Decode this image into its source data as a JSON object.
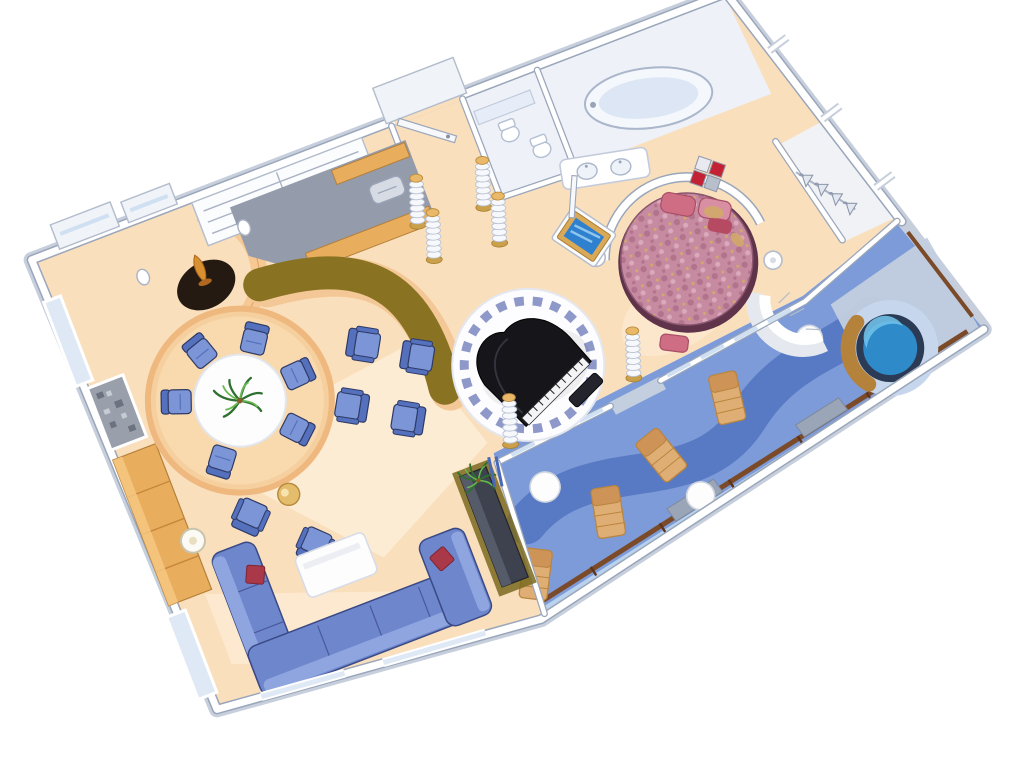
{
  "meta": {
    "title": "Isometric cutaway floor plan of a luxury cruise-ship royal suite with grand piano, round bed and private veranda",
    "view": "axonometric top-down, plan rotated about -21 degrees, white background",
    "canvas": {
      "width": 1024,
      "height": 768
    }
  },
  "rooms": [
    {
      "id": "living-room",
      "label": "Living room: L-shaped blue sectional sofa, red accent pillows, white coffee table, two armchairs with gold side table, floor lamps, dark media cabinet with plant"
    },
    {
      "id": "dining-area",
      "label": "Raised circular dining platform, round white table with palm centerpiece, six blue upholstered chairs"
    },
    {
      "id": "bar",
      "label": "Curved bar with olive-gold countertop, pantry with wood cabinets and sink, sculpture nook with amber vase"
    },
    {
      "id": "entry",
      "label": "Entry hall with open door flanked by ribbed columns with gold capitals"
    },
    {
      "id": "piano-lounge",
      "label": "Circular white platform ringed with blue mosaic tiles, black grand piano with bench"
    },
    {
      "id": "bedroom",
      "label": "Bedroom: round floral bed with pink pillows, curved headboard wall, diamond artwork, gold-framed TV, disc sconces, ottoman"
    },
    {
      "id": "bathroom",
      "label": "Bathroom: oval tub, twin-sink vanity, WC fixtures"
    },
    {
      "id": "closet",
      "label": "Walk-in closet with rail and four hangers"
    },
    {
      "id": "balcony",
      "label": "Private veranda: blue deck with dark wave path, four tan loungers, three round white tables, gray wind dividers, wood railing with glass, round whirlpool with gold surround"
    }
  ],
  "furniture_counts": {
    "dining_chairs": 6,
    "bar_armchairs": 4,
    "lounge_armchairs": 2,
    "sofa_sections": 3,
    "red_pillows": 2,
    "floor_lamps": 2,
    "ribbed_columns": 6,
    "balcony_loungers": 4,
    "balcony_tables": 3,
    "hangers": 4,
    "sinks": 2,
    "tvs": 1,
    "plants": 2
  },
  "palette": {
    "floor_peach": "#fadfbc",
    "floor_light": "#fdf0dc",
    "dining_platform": "#f6cf9e",
    "platform_rim": "#eeb87e",
    "wall_white": "#ffffff",
    "wall_edge": "#9aa6ba",
    "hull_gray": "#c7cfdd",
    "pantry_gray": "#949bab",
    "wood": "#e9ad5e",
    "bar_top_olive": "#897322",
    "bar_base": "#f3c896",
    "furniture_blue": "#7b95d6",
    "furniture_blue_dark": "#5570bc",
    "sofa_blue": "#6e86cc",
    "sofa_light": "#8fa5e0",
    "pillow_red": "#a93848",
    "gold": "#e9b969",
    "vase_amber": "#d89030",
    "piano_black": "#15151a",
    "tile_ring_blue": "#8e99c9",
    "bed_base": "#5f3349",
    "bed_top": "#c78ba1",
    "bed_pillow": "#cf6d85",
    "tv_frame": "#d9a957",
    "tv_screen": "#2f80cf",
    "balcony_blue": "#7d9bd8",
    "balcony_path": "#5677c2",
    "balcony_pad": "#c3cfdf",
    "railing_brown": "#7b4a28",
    "glass_blue": "#b9d2ee",
    "lounger_tan": "#dfae74",
    "hottub_rim": "#2c3b55",
    "hottub_water": "#2e8ac8",
    "hottub_gold": "#b5823c",
    "art_red": "#c22233",
    "plant_green": "#3f8f3f"
  }
}
